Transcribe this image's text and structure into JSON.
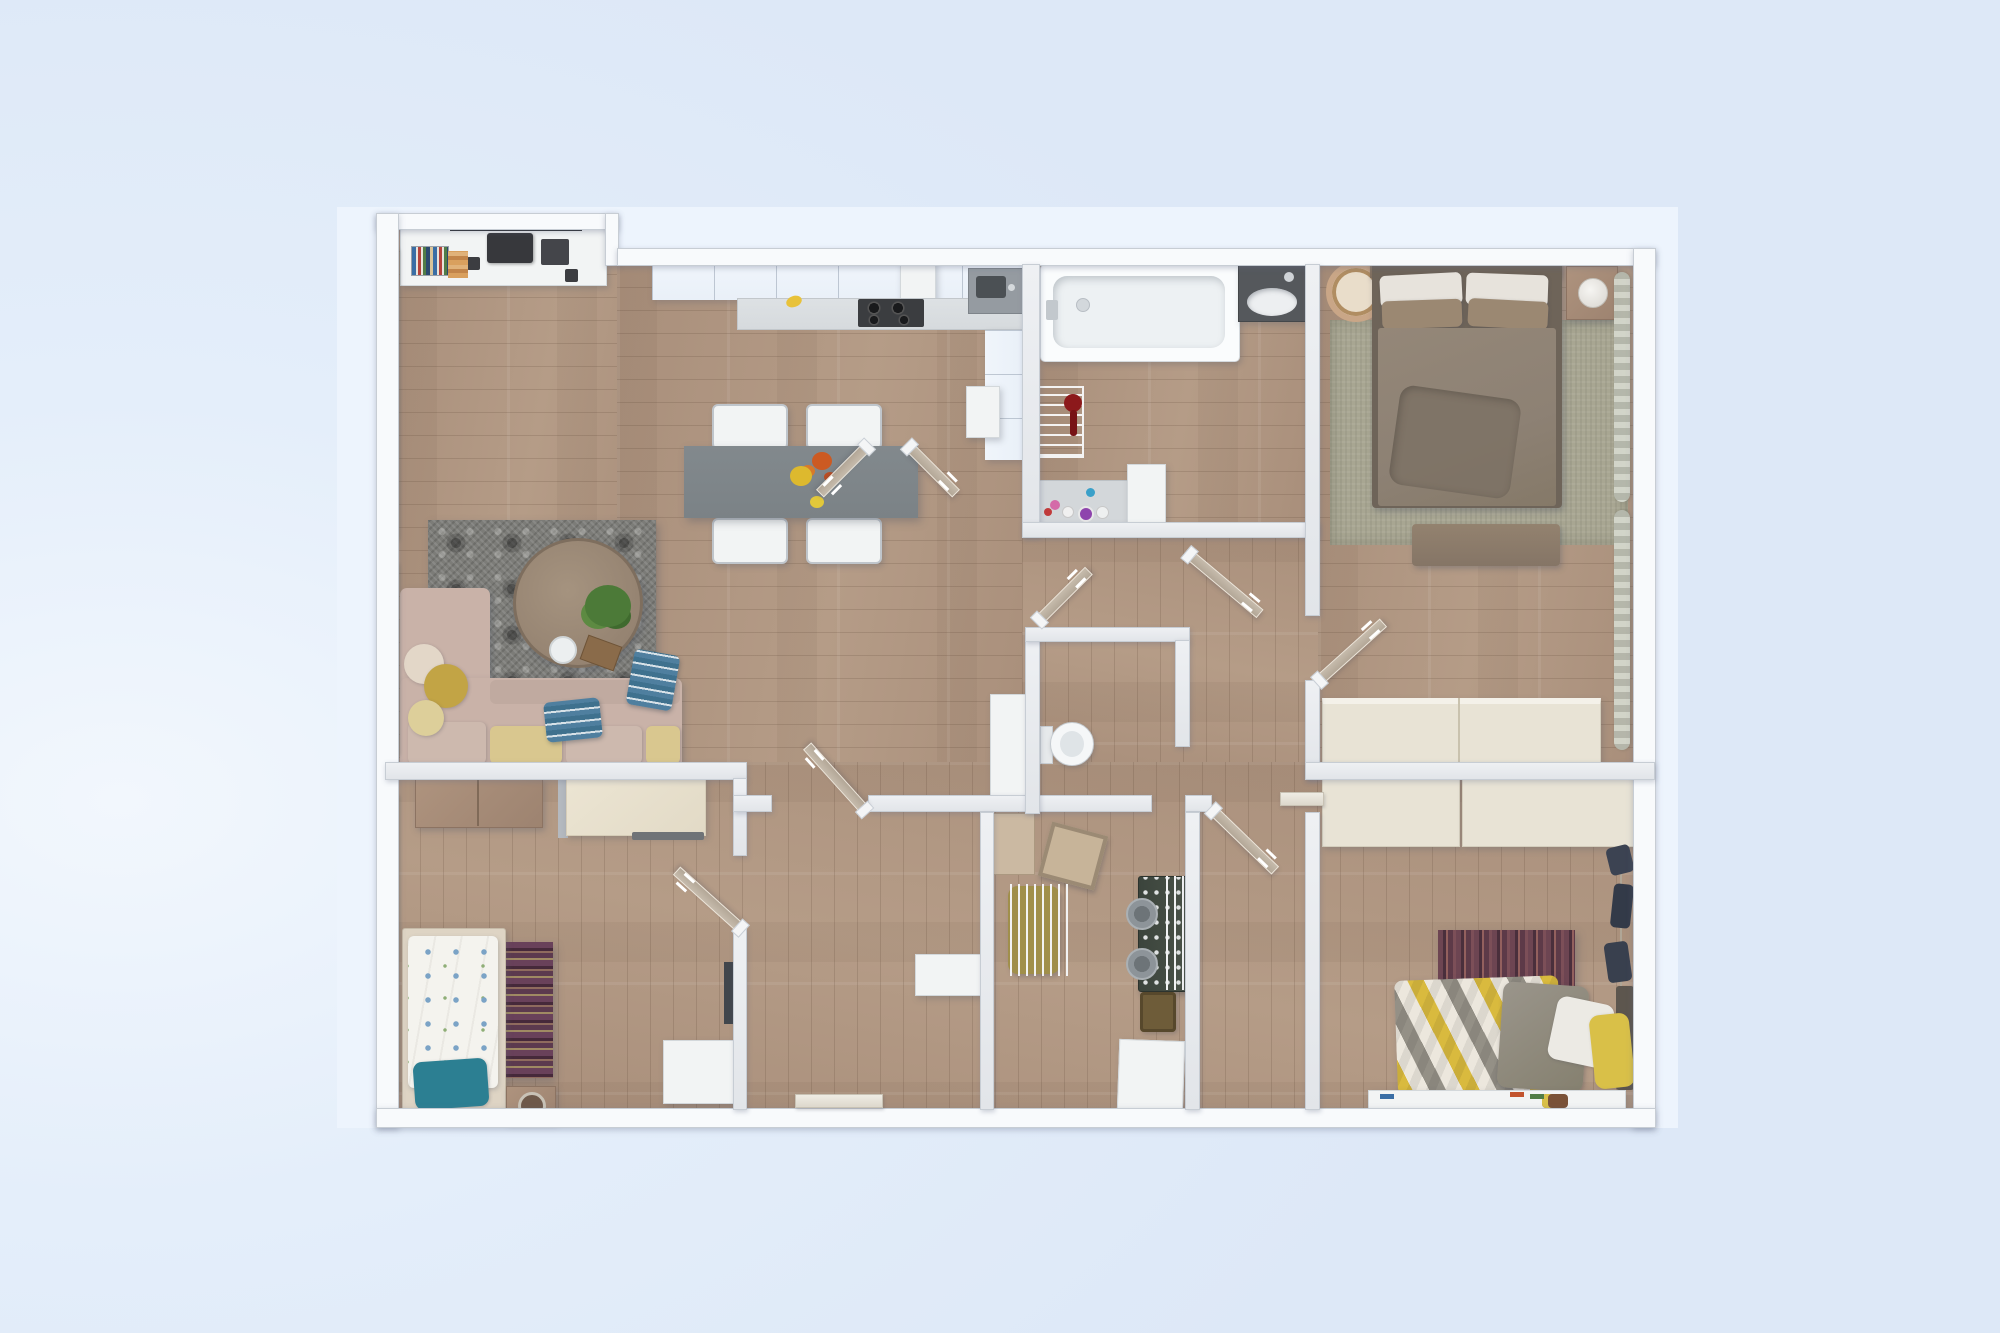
{
  "scene": {
    "type": "3d-floor-plan-render",
    "description": "Top-down photorealistic render of a furnished apartment floor plan centered on a pale blue backdrop",
    "visible_text": "none"
  },
  "palette": {
    "bg": "#e4eefa",
    "bg_light": "#f2f7fd",
    "bg_deep": "#dde8f7",
    "card": "#edf4fd",
    "wood": "#a98f7b",
    "wood2": "#b59c87",
    "wall_outer": "#f8fafc",
    "wall_inner": "#e2e5e9",
    "wall_edge": "#c7cdd4",
    "door": "#b3a797",
    "curtain": "#b6b9ad",
    "rug_gray": "#7c7c78",
    "rug_sage": "#a8a692",
    "rug_maroon": "#6d4552",
    "rug_purple": "#69415a",
    "sofa": "#c9b2a8",
    "cushion_yellow": "#d9c78f",
    "pillow_blue": "#4f7f9f",
    "table_gray": "#7b8286",
    "kcab": "#e9f0f8",
    "counter": "#d6dadd",
    "cooktop": "#3b3d40",
    "bed_taupe": "#8d8174",
    "cream": "#e8e3d5",
    "chev_y": "#d9ba3e",
    "chev_g": "#949086",
    "teal": "#2c7f92",
    "washer": "#4a5248",
    "red_lamp": "#8c191b",
    "toy_car": "#7a5238"
  },
  "rooms": [
    {
      "id": "living-kitchen",
      "label": "Living room with open kitchen and dining area",
      "furniture": [
        "tv-media-console",
        "wall-tv",
        "printer",
        "speakers",
        "book-row",
        "kitchen-upper-cabinets",
        "extractor-hood",
        "kitchen-counter",
        "cooktop",
        "sink-unit",
        "kitchen-column",
        "dishwasher",
        "dining-table",
        "flower-centerpiece",
        "dining-chair x4",
        "gray-patterned-rug",
        "round-coffee-table",
        "potted-plant",
        "plate",
        "serving-tray",
        "corner-sofa",
        "seat-cushions",
        "round-pillows",
        "blue-striped-pillows",
        "window-curtains"
      ]
    },
    {
      "id": "bathroom",
      "label": "Bathroom",
      "furniture": [
        "bathtub",
        "washbasin-vanity",
        "laundry-drying-rack",
        "red-floor-lamp",
        "cosmetics-shelf",
        "tall-white-cabinet"
      ]
    },
    {
      "id": "bedroom-master",
      "label": "Master bedroom",
      "furniture": [
        "double-bed-taupe-duvet",
        "white-pillows",
        "brown-pillows",
        "headboard-shelf",
        "pendant-lamp",
        "nightstand",
        "sphere-table-lamp",
        "sage-area-rug",
        "bedroom-bench",
        "cream-wardrobe",
        "window-curtains"
      ]
    },
    {
      "id": "wc",
      "label": "Separate WC",
      "furniture": [
        "toilet",
        "tall-storage-cabinet"
      ]
    },
    {
      "id": "laundry",
      "label": "Laundry / utility room",
      "furniture": [
        "stacked-washer-dryer",
        "drying-rails",
        "tilted-laundry-basket",
        "olive-chair",
        "tan-cabinet",
        "sewing-table",
        "white-storage-box"
      ]
    },
    {
      "id": "bedroom-kids",
      "label": "Kids bedroom",
      "furniture": [
        "single-bed-floral-duvet",
        "teal-pillow",
        "purple-striped-runner-rug",
        "wood-dresser",
        "framed-desk",
        "round-top-stool",
        "white-cabinet",
        "window-curtain"
      ]
    },
    {
      "id": "bedroom-second",
      "label": "Second bedroom",
      "furniture": [
        "bed-chevron-duvet",
        "gray-folded-blanket",
        "white-pillow",
        "yellow-pillow",
        "maroon-striped-rug",
        "cream-closet x2",
        "hanging-clothes-rail",
        "low-toy-shelf",
        "toy-car",
        "crayons"
      ]
    },
    {
      "id": "hallway",
      "label": "Central hallway",
      "furniture": [
        "open-door x8",
        "flat-door-leaf x2",
        "standing-mirror",
        "wall-shelf"
      ]
    }
  ],
  "doors": {
    "count": 10,
    "style": "light wood leaves shown open at an angle with white handles and hinge blocks"
  }
}
